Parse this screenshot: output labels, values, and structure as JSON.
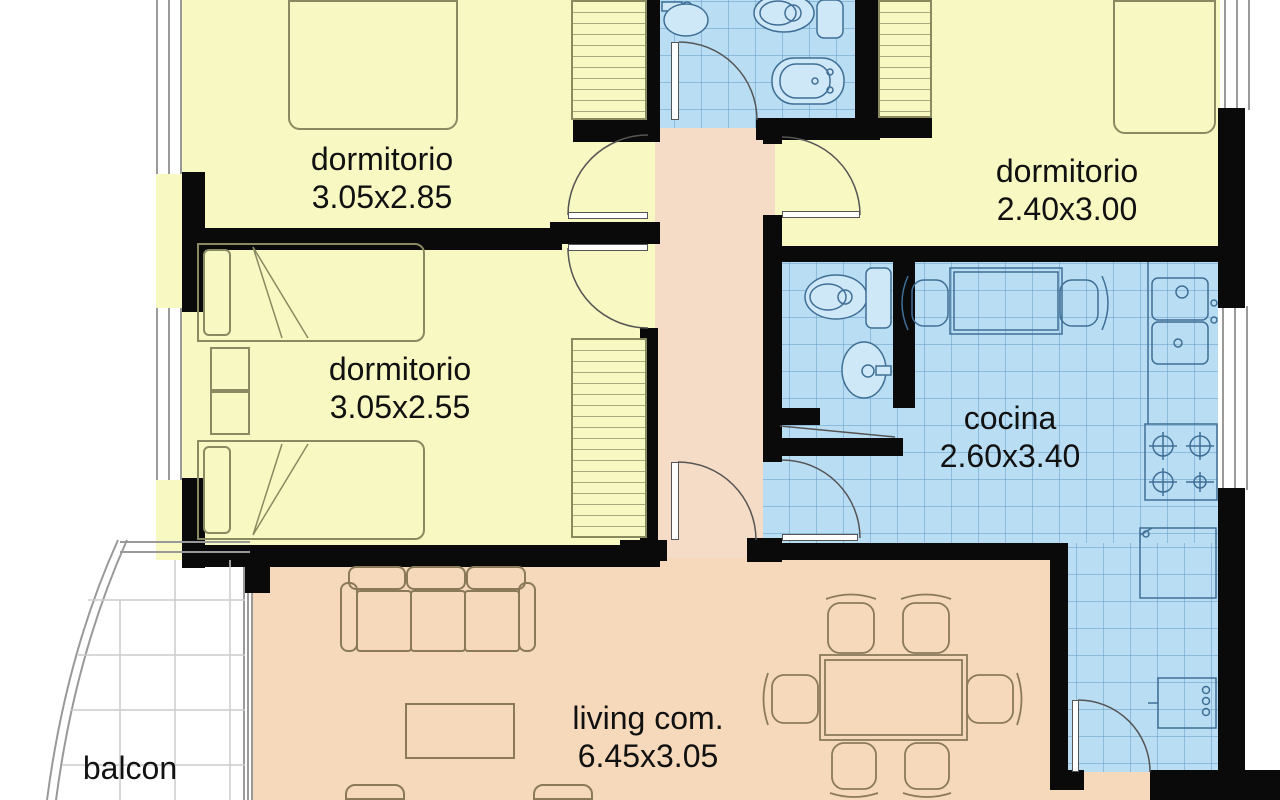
{
  "title": "apartment floor plan",
  "rooms": [
    {
      "id": "dormitorio-1",
      "label": "dormitorio",
      "dims": "3.05x2.85"
    },
    {
      "id": "dormitorio-2",
      "label": "dormitorio",
      "dims": "3.05x2.55"
    },
    {
      "id": "dormitorio-3",
      "label": "dormitorio",
      "dims": "2.40x3.00"
    },
    {
      "id": "cocina",
      "label": "cocina",
      "dims": "2.60x3.40"
    },
    {
      "id": "living",
      "label": "living com.",
      "dims": "6.45x3.05"
    },
    {
      "id": "balcon",
      "label": "balcon",
      "dims": ""
    }
  ],
  "fixtures": {
    "bathroom": [
      "washbasin",
      "toilet",
      "bidet",
      "cistern"
    ],
    "wc": [
      "toilet",
      "washbasin"
    ],
    "kitchen": [
      "dining-table",
      "chairs",
      "double-sink",
      "stove-4-burners",
      "fridge",
      "washing-machine"
    ],
    "bedrooms": [
      "double-bed",
      "single-bed",
      "single-bed",
      "nightstand",
      "wardrobe",
      "wardrobe",
      "wardrobe"
    ],
    "living": [
      "sofa-3-seats",
      "coffee-table",
      "armchairs",
      "dining-table-6-chairs"
    ],
    "balcony": [
      "tiled-floor",
      "curved-railing"
    ]
  },
  "colors": {
    "bedroom_floor": "#f8f8c2",
    "wet_floor": "#b9ddf2",
    "tile_line": "#5a96c3",
    "social_floor": "#f6d8ba",
    "hall_floor": "#f4dcc6",
    "wall": "#0a0a0a",
    "fixture_line": "#4a7aa0",
    "furniture_line": "#8a7a5a",
    "balcony_grid": "#cccccc"
  }
}
